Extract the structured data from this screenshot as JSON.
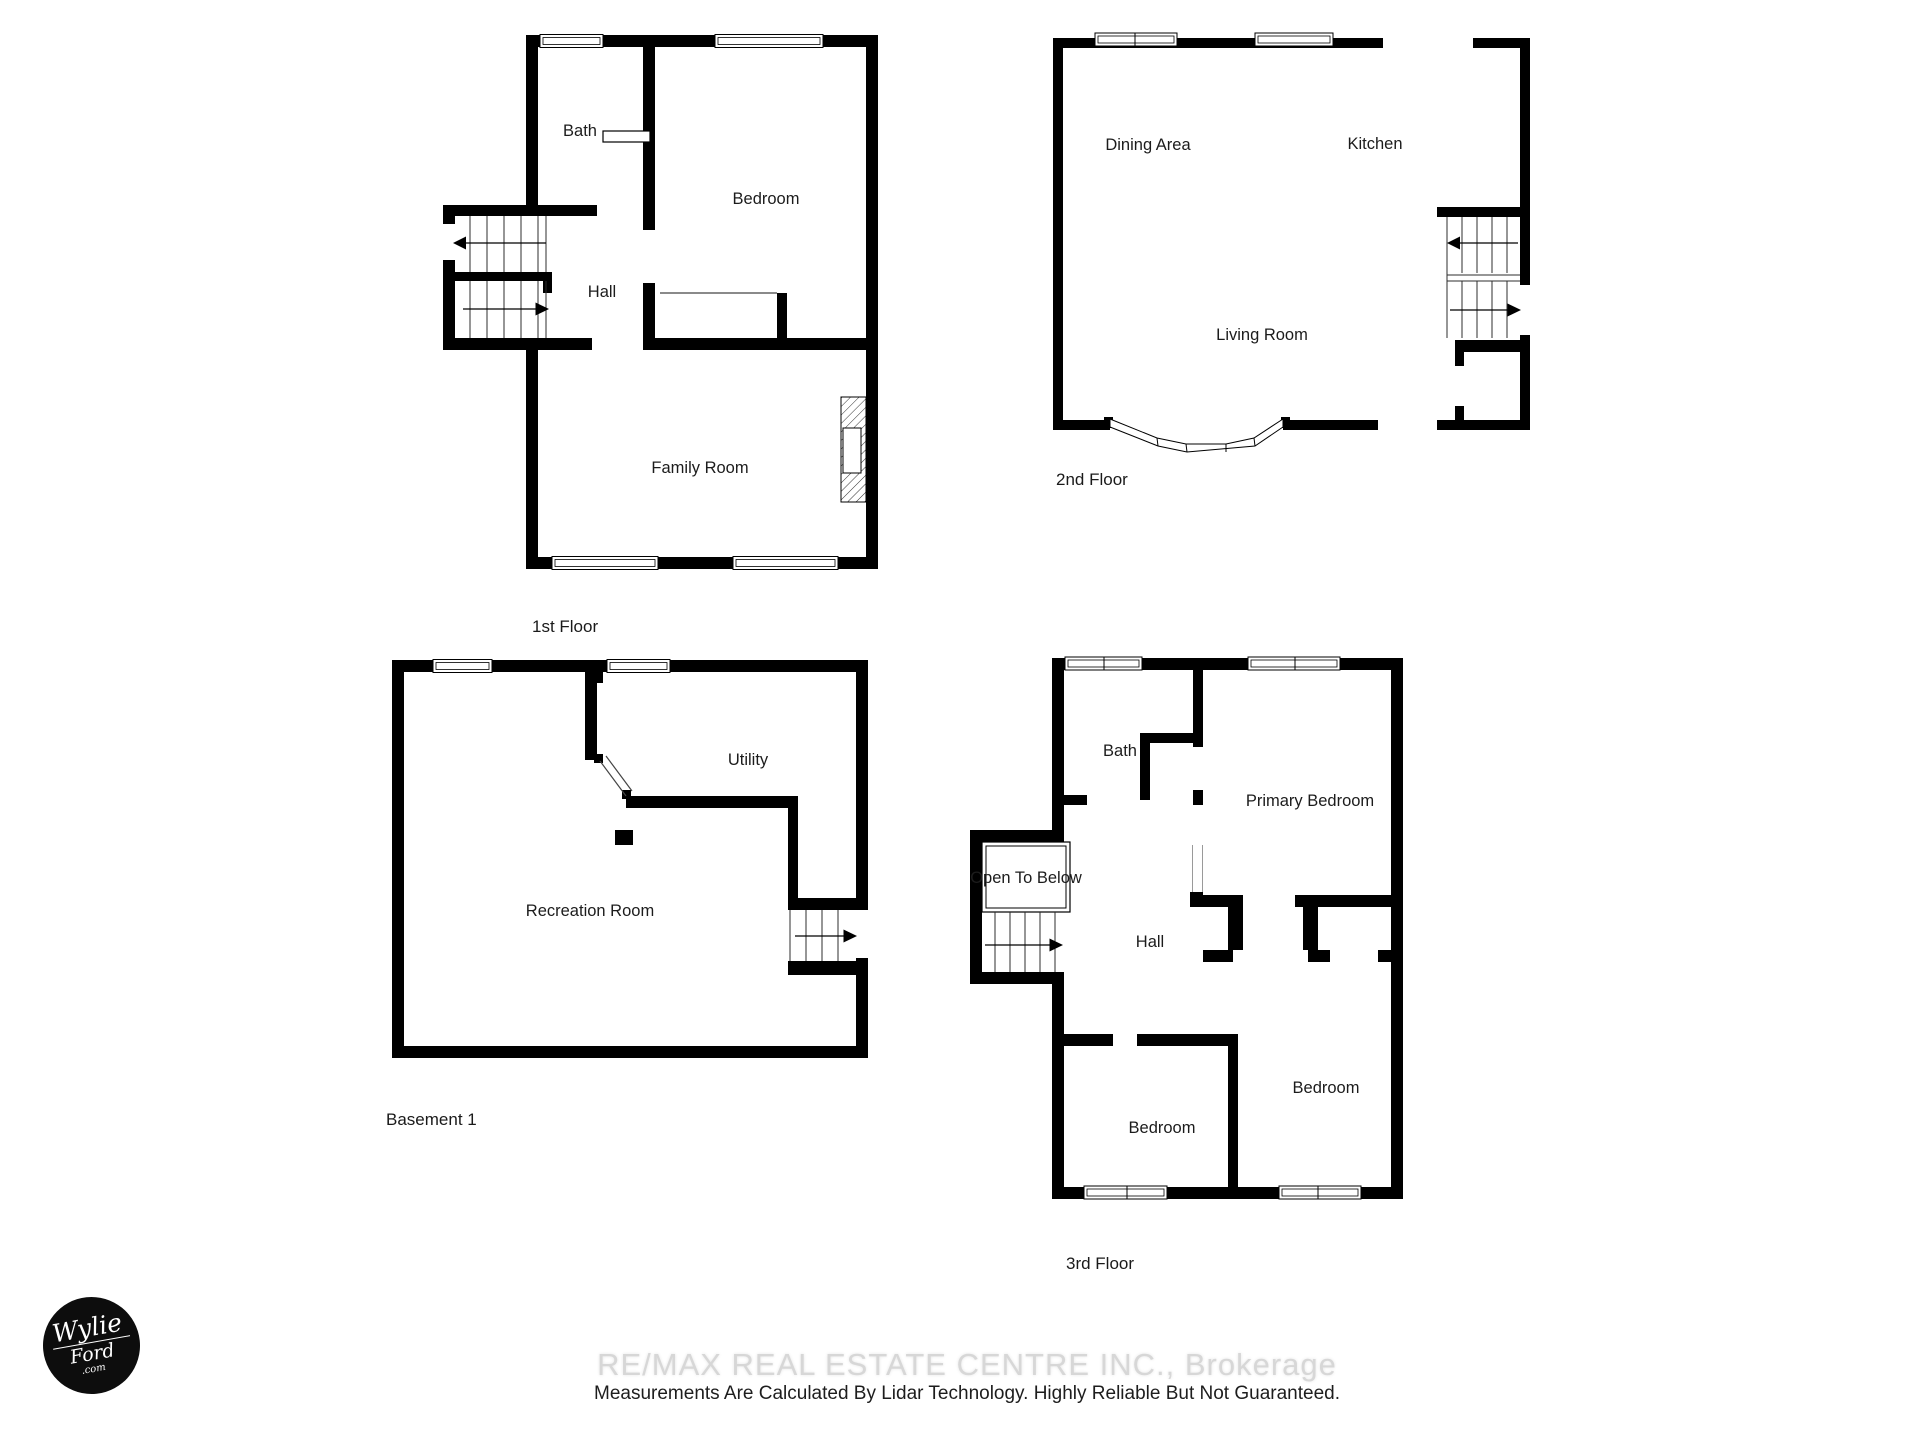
{
  "colors": {
    "wall": "#000000",
    "label_text": "#1c1c1c",
    "watermark": "#d7d7d7",
    "logo_bg": "#0d0d0d"
  },
  "floor1": {
    "title": "1st Floor",
    "bath": "Bath",
    "bedroom": "Bedroom",
    "hall": "Hall",
    "family": "Family Room"
  },
  "floor2": {
    "title": "2nd Floor",
    "dining": "Dining Area",
    "kitchen": "Kitchen",
    "living": "Living Room"
  },
  "basement": {
    "title": "Basement 1",
    "utility": "Utility",
    "recreation": "Recreation Room"
  },
  "floor3": {
    "title": "3rd Floor",
    "bath": "Bath",
    "primary": "Primary Bedroom",
    "open_below": "Open To Below",
    "hall": "Hall",
    "bedroom_a": "Bedroom",
    "bedroom_b": "Bedroom"
  },
  "footer": {
    "watermark": "RE/MAX REAL ESTATE CENTRE INC., Brokerage",
    "disclaimer": "Measurements Are Calculated By Lidar Technology. Highly Reliable But Not Guaranteed."
  },
  "logo": {
    "line1": "Wylie",
    "line2": "Ford",
    "line3": ".com"
  }
}
